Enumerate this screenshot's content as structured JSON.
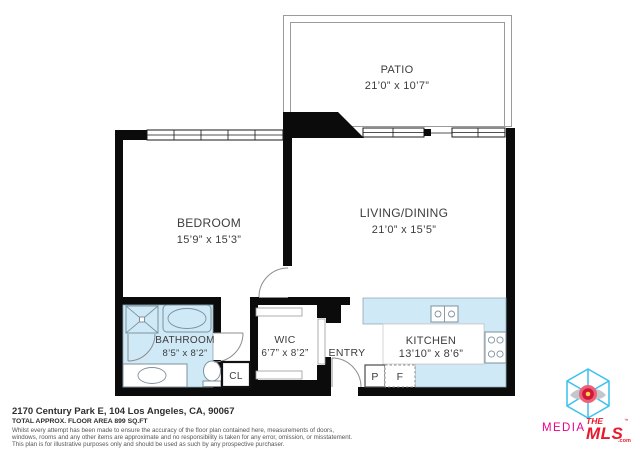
{
  "colors": {
    "wall": "#0b0b0b",
    "plan_blue": "#cfe9f6",
    "fixture_line": "#7d929e",
    "patio_line": "#9b9b9b",
    "label_text": "#3d3d3d",
    "logo_cube": "#39c1ee",
    "logo_media": "#ec008c",
    "logo_mls": "#e8192c"
  },
  "rooms": {
    "patio": {
      "name": "PATIO",
      "dims": "21’0” x 10’7”"
    },
    "bedroom": {
      "name": "BEDROOM",
      "dims": "15’9” x 15’3”"
    },
    "living": {
      "name": "LIVING/DINING",
      "dims": "21’0” x 15’5”"
    },
    "bathroom": {
      "name": "BATHROOM",
      "dims": "8’5” x 8’2”"
    },
    "wic": {
      "name": "WIC",
      "dims": "6’7” x 8’2”"
    },
    "kitchen": {
      "name": "KITCHEN",
      "dims": "13’10” x 8’6”"
    },
    "entry": {
      "name": "ENTRY"
    },
    "closet": {
      "name": "CL"
    },
    "pantry": {
      "name": "P"
    },
    "fridge": {
      "name": "F"
    }
  },
  "footer": {
    "address": "2170 Century Park E, 104 Los Angeles, CA, 90067",
    "area": "TOTAL APPROX. FLOOR AREA 899 SQ.FT",
    "disclaimer": [
      "Whilst every attempt has been made to ensure the accuracy of the floor plan contained here, measurements of doors,",
      "windows, rooms and any other items are approximate and no responsibility is taken for any error, omission, or misstatement.",
      "This plan is for illustrative purposes only and should be used as such by any prospective purchaser."
    ]
  },
  "logo": {
    "media": "MEDIA",
    "the": "THE",
    "mls": "MLS",
    "tm": "™",
    "com": ".com"
  }
}
